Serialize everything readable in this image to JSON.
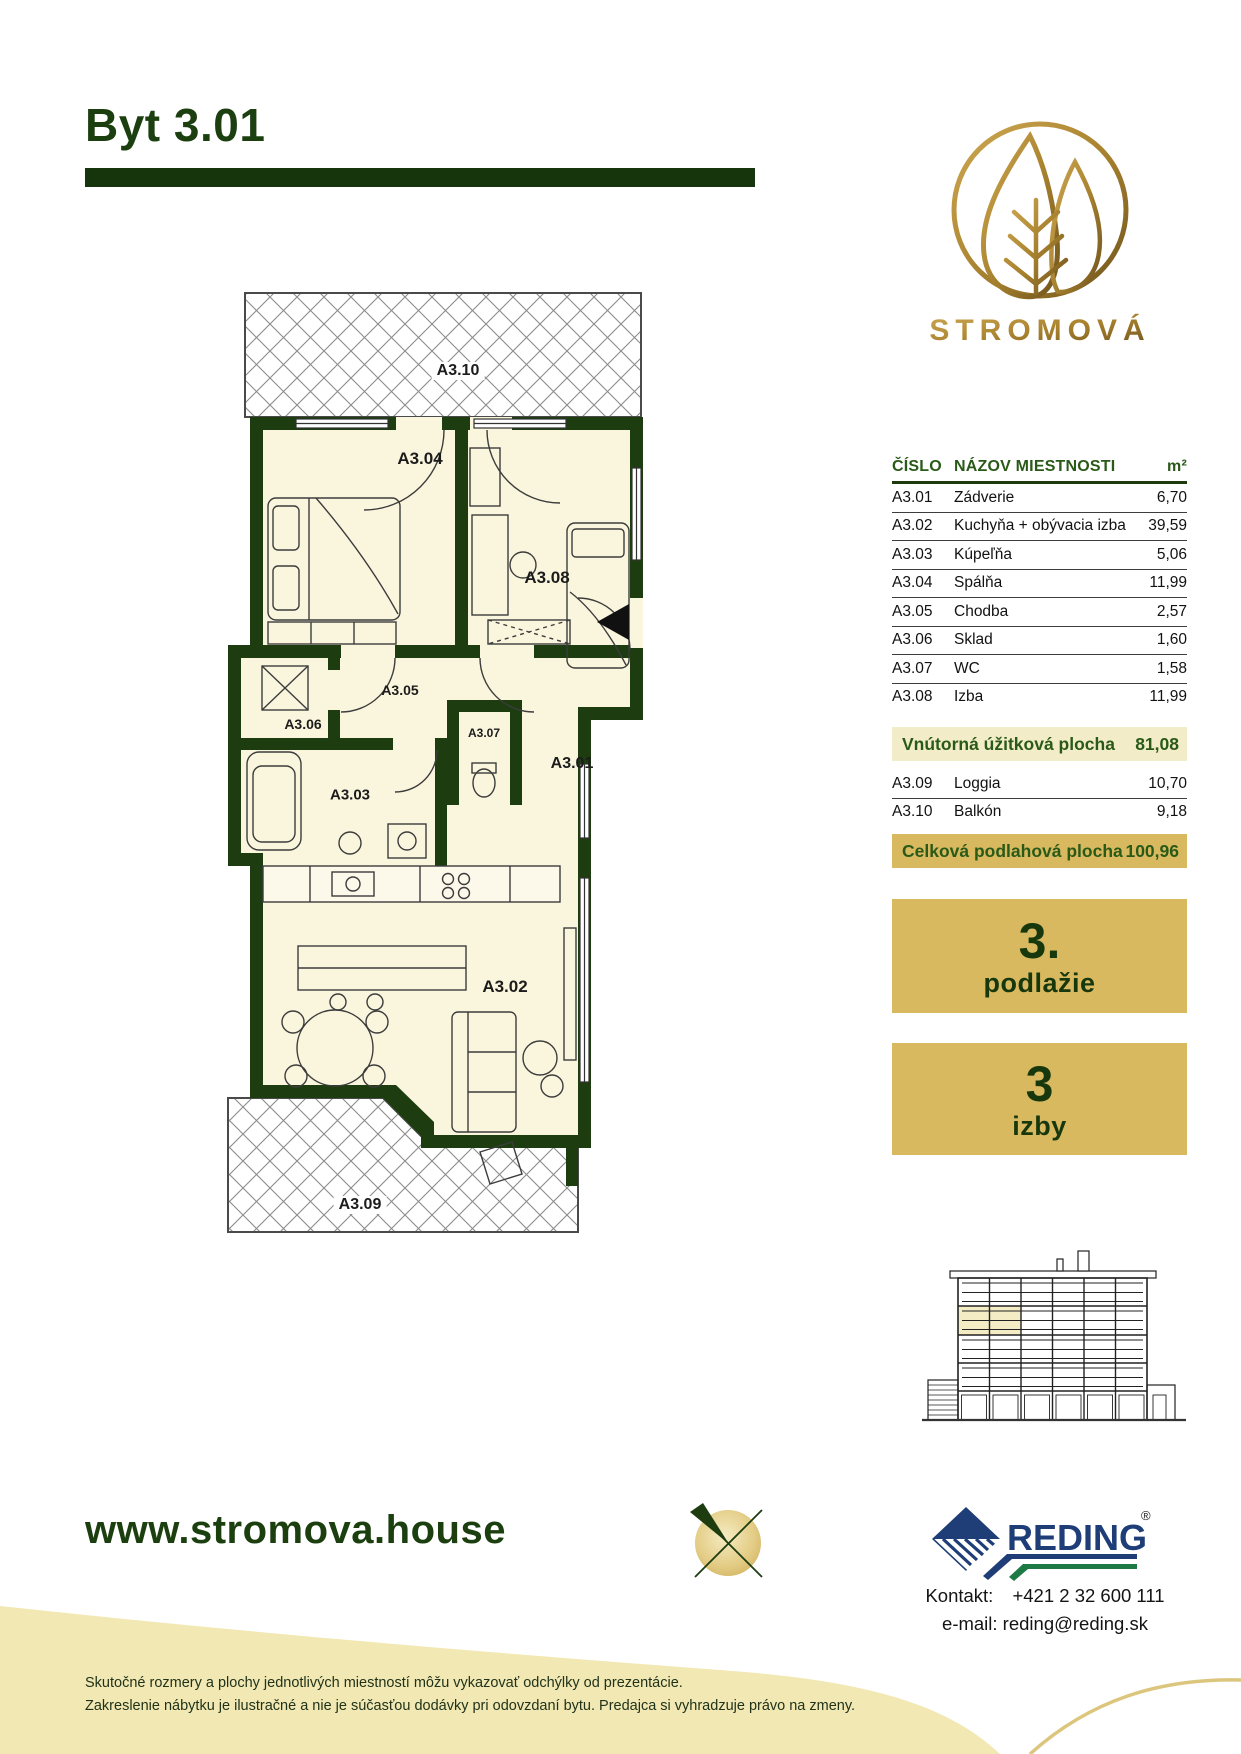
{
  "header": {
    "title": "Byt 3.01"
  },
  "brand": {
    "name": "STROMOVÁ"
  },
  "rooms_table": {
    "col_number": "ČÍSLO",
    "col_name": "NÁZOV MIESTNOSTI",
    "col_area": "m²",
    "rows": [
      {
        "number": "A3.01",
        "name": "Zádverie",
        "area": "6,70"
      },
      {
        "number": "A3.02",
        "name": "Kuchyňa + obývacia izba",
        "area": "39,59"
      },
      {
        "number": "A3.03",
        "name": "Kúpeľňa",
        "area": "5,06"
      },
      {
        "number": "A3.04",
        "name": "Spálňa",
        "area": "11,99"
      },
      {
        "number": "A3.05",
        "name": "Chodba",
        "area": "2,57"
      },
      {
        "number": "A3.06",
        "name": "Sklad",
        "area": "1,60"
      },
      {
        "number": "A3.07",
        "name": "WC",
        "area": "1,58"
      },
      {
        "number": "A3.08",
        "name": "Izba",
        "area": "11,99"
      }
    ],
    "subtotal": {
      "label": "Vnútorná úžitková plocha",
      "value": "81,08"
    },
    "exterior_rows": [
      {
        "number": "A3.09",
        "name": "Loggia",
        "area": "10,70"
      },
      {
        "number": "A3.10",
        "name": "Balkón",
        "area": "9,18"
      }
    ],
    "total": {
      "label": "Celková podlahová plocha",
      "value": "100,96"
    }
  },
  "badges": {
    "floor": {
      "value": "3.",
      "label": "podlažie"
    },
    "rooms": {
      "value": "3",
      "label": "izby"
    }
  },
  "floor_plan": {
    "labels": [
      "A3.10",
      "A3.04",
      "A3.08",
      "A3.06",
      "A3.05",
      "A3.07",
      "A3.01",
      "A3.03",
      "A3.02",
      "A3.09"
    ]
  },
  "footer": {
    "website": "www.stromova.house",
    "partner_logo": "REDING",
    "registered_mark": "®",
    "contact_label": "Kontakt:",
    "phone": "+421 2 32 600 111",
    "email_line": "e-mail: reding@reding.sk",
    "disclaimer_line1": "Skutočné rozmery a plochy jednotlivých miestností môžu vykazovať odchýlky od prezentácie.",
    "disclaimer_line2": "Zakreslenie nábytku je ilustračné a nie je súčasťou dodávky pri odovzdaní bytu. Predajca si vyhradzuje právo na zmeny."
  },
  "colors": {
    "dark_green": "#1b3a0e",
    "gold": "#d9b95f",
    "cream_row": "#f2edc8",
    "band_cream": "#f2e8b4"
  }
}
